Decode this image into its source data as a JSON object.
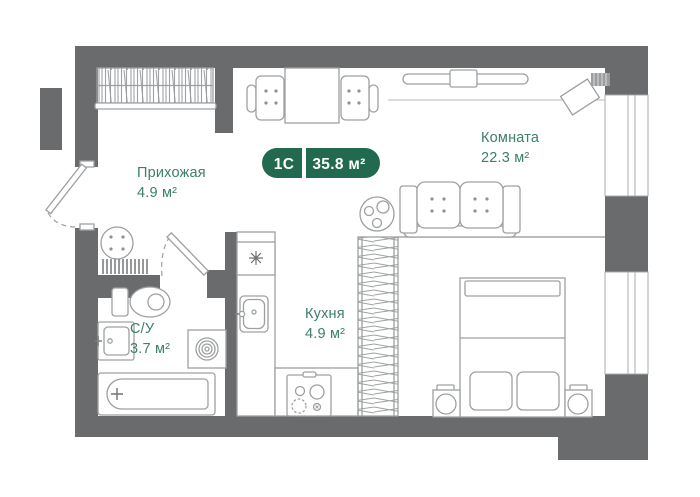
{
  "plan": {
    "badge": {
      "type_label": "1С",
      "area_label": "35.8 м²"
    },
    "rooms": [
      {
        "name": "Прихожая",
        "area": "4.9 м²"
      },
      {
        "name": "Комната",
        "area": "22.3 м²"
      },
      {
        "name": "Кухня",
        "area": "4.9 м²"
      },
      {
        "name": "С/У",
        "area": "3.7 м²"
      }
    ],
    "colors": {
      "badge_green": "#216a50",
      "label_green": "#3c8066",
      "wall_gray": "#696b6d",
      "furniture_gray": "#9da0a2"
    }
  }
}
